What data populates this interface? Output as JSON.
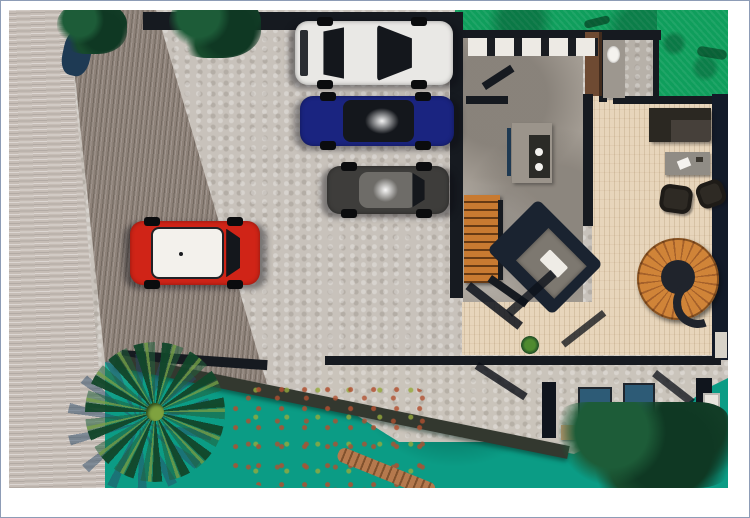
{
  "page": {
    "background": "#ffffff",
    "frame_border_color": "#8d9cb6",
    "alt": "Top-down 3D architectural render of a modern tropical house with street, driveway, four cars, interior floor plan, wood deck, pool terrace and landscaping"
  },
  "scene": {
    "colors": {
      "street": "#c6bdb6",
      "driveway": "#8d8178",
      "parking": "#c8c2bb",
      "lawn": "#0f9e5c",
      "water": "#0b9c85",
      "deck_wood": "#e7d5bb",
      "interior_stone": "#a39c93",
      "bathroom_floor": "#b7b1a9",
      "terrace": "#cac4bb",
      "wall": "#161a20",
      "wall_navy": "#131b29",
      "pier": "#33382f",
      "closet_wood": "#6e4a32",
      "stair_wood": "#c87a31",
      "island": "#9b948b",
      "island_top": "#2b2b27",
      "bench_blue": "#1e3952",
      "sofa_seat": "#46403a",
      "sofa_back": "#2b2822",
      "armchair": "#2e2a24",
      "rug": "#908c85",
      "bed": "#7d7870",
      "bedroom_dark": "#1a2330",
      "pillow": "#efece6",
      "sunbed": "#2d5b76",
      "sunbed_frame": "#20262e",
      "cushion": "#c49a70",
      "planter": "#10151d",
      "door_white": "#e9e5de",
      "pond": "#1e3a54",
      "trunk": "#b5794d",
      "palm_core": "#7fa23f"
    },
    "vehicles": [
      {
        "name": "white-sports-car",
        "body": "#e9e8e5"
      },
      {
        "name": "blue-sedan",
        "body": "#1a2480"
      },
      {
        "name": "charcoal-coupe",
        "body": "#3e3d3b"
      },
      {
        "name": "red-mini-suv",
        "body": "#d02417",
        "roof": "#f3f1ec"
      }
    ]
  }
}
